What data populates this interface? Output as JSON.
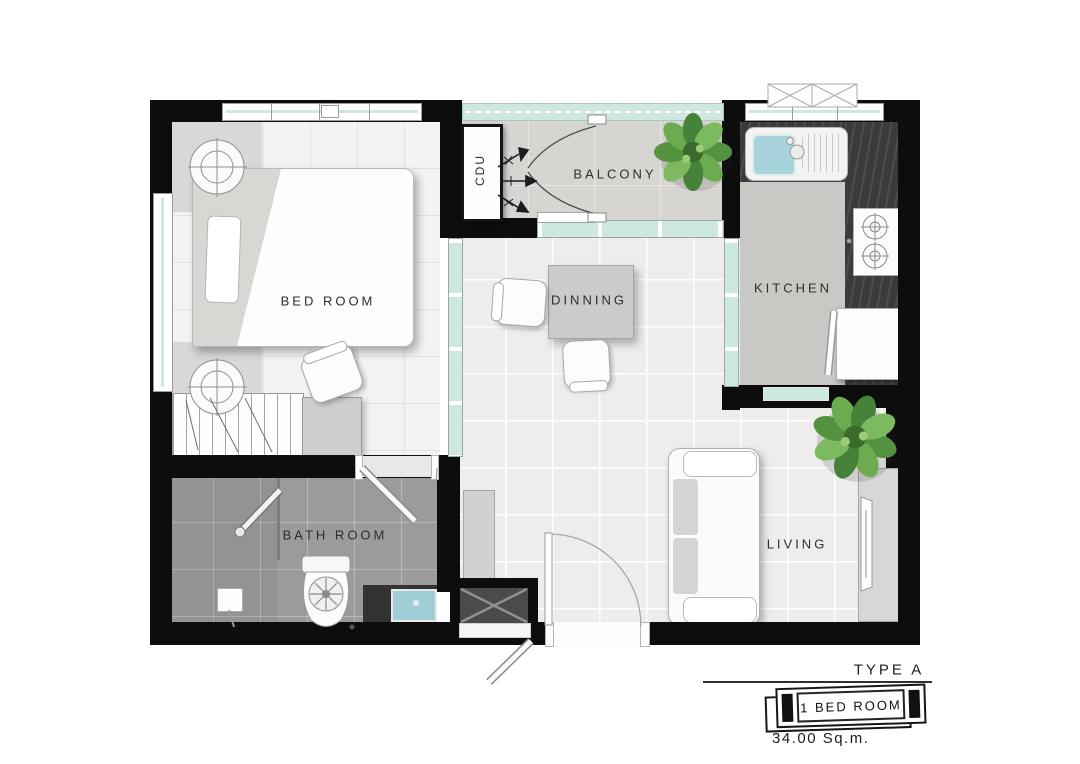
{
  "rooms": {
    "bedroom": "BED ROOM",
    "balcony": "BALCONY",
    "kitchen": "KITCHEN",
    "dining": "DINNING",
    "bathroom": "BATH ROOM",
    "living": "LIVING"
  },
  "annotations": {
    "cdu": "CDU"
  },
  "footer": {
    "type_label": "TYPE A",
    "unit_badge": "1 BED ROOM",
    "area": "34.00 Sq.m."
  },
  "symbols": [
    "double-bed",
    "nightstand-lamp",
    "wardrobe",
    "dresser",
    "desk-chair",
    "dining-table",
    "dining-chair",
    "sofa",
    "tv-console",
    "tv",
    "indoor-plant",
    "kitchen-sink",
    "gas-stove",
    "refrigerator",
    "counter",
    "toilet",
    "shower",
    "vanity-sink",
    "condensing-unit",
    "entry-door",
    "bathroom-door",
    "folding-door",
    "sliding-door",
    "window",
    "glass-railing",
    "service-shaft"
  ],
  "colors": {
    "wall": "#0d0d0d",
    "floor_light": "#eeedeb",
    "floor_bedroom": "#f4f3f1",
    "floor_balcony": "#d6d5d2",
    "floor_kitchen": "#cac8c5",
    "floor_bathroom": "#9c9b99",
    "glass": "#cde8de",
    "counter_dark": "#3b3b3b",
    "sink_blue": "#a7d4dc",
    "plant_green": "#55923f",
    "furniture_gray": "#d4d3d1"
  }
}
